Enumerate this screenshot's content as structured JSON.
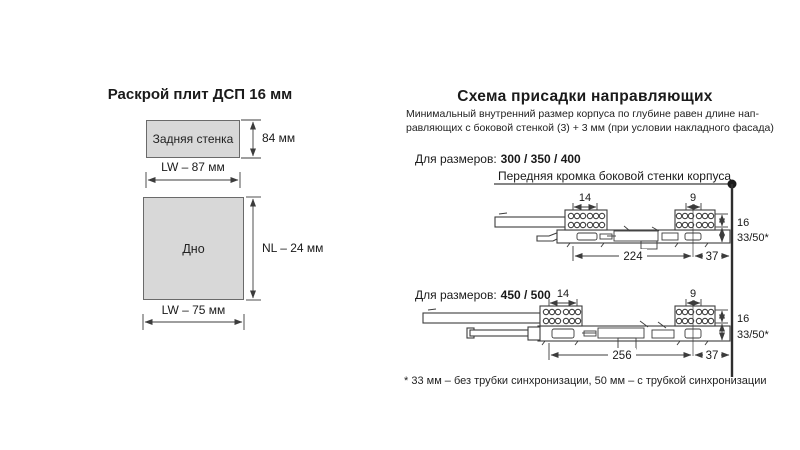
{
  "colors": {
    "ink": "#1a1a1a",
    "line": "#3c3c3c",
    "panel_fill": "#d8d8d8"
  },
  "cutting": {
    "title": "Раскрой плит ДСП 16 мм",
    "back_wall": {
      "name": "Задняя стенка",
      "height": "84 мм",
      "width": "LW – 87 мм"
    },
    "bottom_panel": {
      "name": "Дно",
      "height": "NL – 24 мм",
      "width": "LW – 75 мм"
    }
  },
  "drilling": {
    "title": "Схема присадки направляющих",
    "note_line1": "Минимальный внутренний размер корпуса по глубине равен длине нап-",
    "note_line2": "равляющих с боковой стенкой (3) + 3 мм (при условии накладного фасада)",
    "sizes_label": "Для размеров:",
    "front_edge_label": "Передняя кромка боковой стенки корпуса",
    "diagram1": {
      "sizes": "300 / 350 / 400",
      "dim_left_group": "14",
      "dim_right_group": "9",
      "dim_back": "224",
      "dim_front": "37",
      "dim_rows": "16",
      "dim_height": "33/50*"
    },
    "diagram2": {
      "sizes": "450 / 500",
      "dim_left_group": "14",
      "dim_right_group": "9",
      "dim_back": "256",
      "dim_front": "37",
      "dim_rows": "16",
      "dim_height": "33/50*"
    },
    "footnote": "* 33 мм – без трубки синхронизации, 50 мм – с трубкой синхронизации"
  }
}
